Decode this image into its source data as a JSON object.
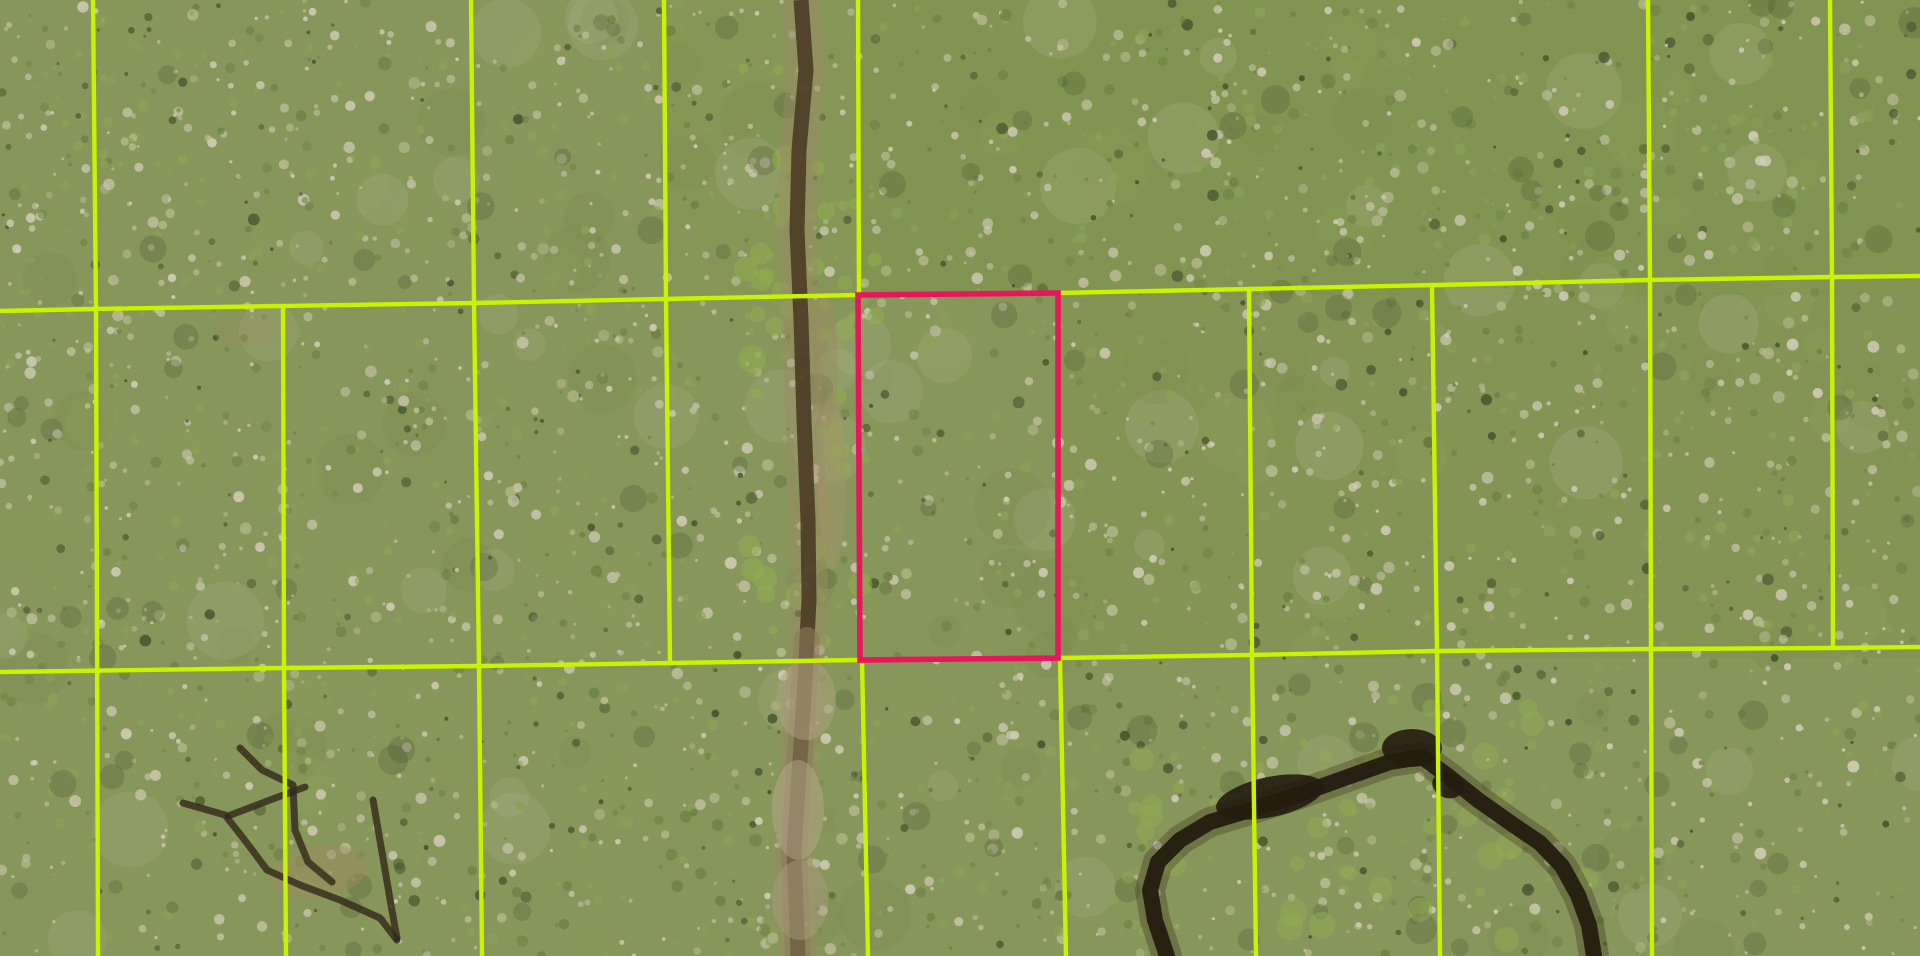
{
  "meta": {
    "view": "aerial-parcel-map",
    "canvas_width": 1920,
    "canvas_height": 956
  },
  "map": {
    "background_color": "#87965a",
    "boundary_line_color": "#c9f301",
    "boundary_line_width": 4.4,
    "highlight_color": "#e8175d",
    "highlight_line_width": 5.6,
    "parcel_boundaries": [
      [
        [
          0,
          311
        ],
        [
          94,
          309
        ],
        [
          474,
          303
        ],
        [
          664,
          299
        ],
        [
          858,
          295
        ],
        [
          1058,
          293
        ],
        [
          1250,
          289
        ],
        [
          1437,
          285
        ],
        [
          1649,
          280
        ],
        [
          1832,
          277
        ],
        [
          1920,
          276
        ]
      ],
      [
        [
          0,
          672
        ],
        [
          283,
          668
        ],
        [
          479,
          666
        ],
        [
          670,
          663
        ],
        [
          858,
          660
        ],
        [
          1058,
          658
        ],
        [
          1250,
          655
        ],
        [
          1437,
          651
        ],
        [
          1649,
          649
        ],
        [
          1832,
          648
        ],
        [
          1920,
          647
        ]
      ],
      [
        [
          93,
          0
        ],
        [
          96,
          311
        ],
        [
          98,
          956
        ]
      ],
      [
        [
          471,
          0
        ],
        [
          474,
          303
        ],
        [
          479,
          666
        ],
        [
          482,
          956
        ]
      ],
      [
        [
          664,
          0
        ],
        [
          666,
          299
        ],
        [
          670,
          663
        ]
      ],
      [
        [
          858,
          0
        ],
        [
          859,
          295
        ]
      ],
      [
        [
          1648,
          0
        ],
        [
          1650,
          280
        ],
        [
          1651,
          649
        ],
        [
          1652,
          956
        ]
      ],
      [
        [
          1830,
          0
        ],
        [
          1832,
          277
        ],
        [
          1833,
          648
        ]
      ],
      [
        [
          283,
          306
        ],
        [
          284,
          668
        ],
        [
          286,
          956
        ]
      ],
      [
        [
          1249,
          289
        ],
        [
          1252,
          655
        ],
        [
          1256,
          956
        ]
      ],
      [
        [
          1432,
          285
        ],
        [
          1437,
          651
        ],
        [
          1440,
          956
        ]
      ],
      [
        [
          862,
          660
        ],
        [
          868,
          956
        ]
      ],
      [
        [
          1060,
          658
        ],
        [
          1066,
          956
        ]
      ]
    ],
    "highlighted_parcel": {
      "polygon": [
        [
          858,
          295
        ],
        [
          1058,
          293
        ],
        [
          1058,
          658
        ],
        [
          860,
          660
        ]
      ]
    },
    "dirt_road": {
      "centerline": [
        [
          801,
          0
        ],
        [
          806,
          70
        ],
        [
          799,
          150
        ],
        [
          797,
          230
        ],
        [
          801,
          320
        ],
        [
          804,
          420
        ],
        [
          808,
          520
        ],
        [
          809,
          600
        ],
        [
          805,
          680
        ],
        [
          800,
          760
        ],
        [
          794,
          850
        ],
        [
          798,
          956
        ]
      ],
      "lower_centerline": [
        [
          807,
          640
        ],
        [
          803,
          700
        ],
        [
          799,
          770
        ],
        [
          794,
          850
        ],
        [
          798,
          956
        ]
      ],
      "margin_color": "#9c8a66",
      "margin_width": 38,
      "margin_opacity": 0.45,
      "core_color": "#4a3823",
      "core_width": 15,
      "core_opacity": 0.88,
      "lower_overlay_color": "#8d7c5a",
      "lower_overlay_width": 26,
      "lower_overlay_opacity": 0.6
    },
    "creek": {
      "centerline": [
        [
          1167,
          956
        ],
        [
          1155,
          920
        ],
        [
          1150,
          890
        ],
        [
          1158,
          862
        ],
        [
          1180,
          840
        ],
        [
          1210,
          822
        ],
        [
          1250,
          810
        ],
        [
          1300,
          794
        ],
        [
          1345,
          778
        ],
        [
          1390,
          762
        ],
        [
          1422,
          757
        ],
        [
          1448,
          776
        ],
        [
          1478,
          800
        ],
        [
          1512,
          824
        ],
        [
          1540,
          843
        ],
        [
          1562,
          866
        ],
        [
          1578,
          895
        ],
        [
          1589,
          925
        ],
        [
          1594,
          956
        ]
      ],
      "water_color": "#241c10",
      "width": 16,
      "margin_color": "#3f3520",
      "margin_width": 30,
      "margin_opacity": 0.35,
      "pools": [
        {
          "cx": 1270,
          "cy": 797,
          "rx": 55,
          "ry": 20,
          "rot": -12
        },
        {
          "cx": 1412,
          "cy": 748,
          "rx": 30,
          "ry": 19,
          "rot": 0
        },
        {
          "cx": 1448,
          "cy": 785,
          "rx": 16,
          "ry": 13,
          "rot": 20
        }
      ]
    },
    "wet_trails": {
      "color": "#33281a",
      "width": 7,
      "opacity": 0.8,
      "paths": [
        [
          [
            183,
            803
          ],
          [
            225,
            815
          ],
          [
            247,
            843
          ],
          [
            267,
            870
          ],
          [
            300,
            885
          ],
          [
            340,
            900
          ],
          [
            380,
            918
          ],
          [
            397,
            940
          ]
        ],
        [
          [
            240,
            748
          ],
          [
            262,
            770
          ],
          [
            293,
            785
          ],
          [
            295,
            830
          ],
          [
            308,
            862
          ],
          [
            332,
            882
          ]
        ],
        [
          [
            373,
            800
          ],
          [
            383,
            858
          ],
          [
            391,
            905
          ],
          [
            397,
            938
          ]
        ],
        [
          [
            228,
            816
          ],
          [
            270,
            800
          ],
          [
            305,
            787
          ]
        ]
      ]
    },
    "dirt_patches": [
      {
        "cx": 832,
        "cy": 480,
        "rx": 14,
        "ry": 90,
        "rot": 0,
        "color": "#a4916c",
        "opacity": 0.5
      },
      {
        "cx": 826,
        "cy": 360,
        "rx": 12,
        "ry": 70,
        "rot": 0,
        "color": "#9c8a66",
        "opacity": 0.45
      },
      {
        "cx": 806,
        "cy": 700,
        "rx": 30,
        "ry": 40,
        "rot": 0,
        "color": "#b0a182",
        "opacity": 0.5
      },
      {
        "cx": 798,
        "cy": 810,
        "rx": 26,
        "ry": 50,
        "rot": 0,
        "color": "#b5a88a",
        "opacity": 0.5
      },
      {
        "cx": 800,
        "cy": 900,
        "rx": 28,
        "ry": 40,
        "rot": 0,
        "color": "#a89a7c",
        "opacity": 0.5
      },
      {
        "cx": 320,
        "cy": 872,
        "rx": 48,
        "ry": 26,
        "rot": -10,
        "color": "#9f8a62",
        "opacity": 0.45
      },
      {
        "cx": 255,
        "cy": 330,
        "rx": 40,
        "ry": 16,
        "rot": -8,
        "color": "#95905e",
        "opacity": 0.3
      }
    ],
    "forest": {
      "seed": 1337,
      "speckle_count": 3400,
      "speckle_palette": [
        {
          "color": "#d2cdb8",
          "weight": 0.32
        },
        {
          "color": "#b9bd92",
          "weight": 0.18
        },
        {
          "color": "#8ba157",
          "weight": 0.22
        },
        {
          "color": "#6e8245",
          "weight": 0.17
        },
        {
          "color": "#46522e",
          "weight": 0.11
        }
      ],
      "patch_count": 150,
      "patch_palette": [
        "#c9c4ac",
        "#93a75c",
        "#75874a"
      ],
      "dark_patch_count": 120,
      "dark_patch_color": "#3c4827",
      "tint_regions": [
        {
          "x": 858,
          "y": 0,
          "w": 1062,
          "h": 295,
          "color": "#76913f",
          "opacity": 0.3
        },
        {
          "x": 1058,
          "y": 293,
          "w": 862,
          "h": 365,
          "color": "#76913f",
          "opacity": 0.16
        },
        {
          "x": 664,
          "y": 0,
          "w": 194,
          "h": 299,
          "color": "#7e9746",
          "opacity": 0.18
        }
      ],
      "accent_clusters": [
        {
          "x": 740,
          "w": 140,
          "y": 60,
          "h": 640,
          "count": 45,
          "color": "#8fae4e",
          "opacity": 0.55
        },
        {
          "x": 1100,
          "w": 500,
          "y": 700,
          "h": 240,
          "count": 40,
          "color": "#93b050",
          "opacity": 0.45
        }
      ]
    }
  }
}
